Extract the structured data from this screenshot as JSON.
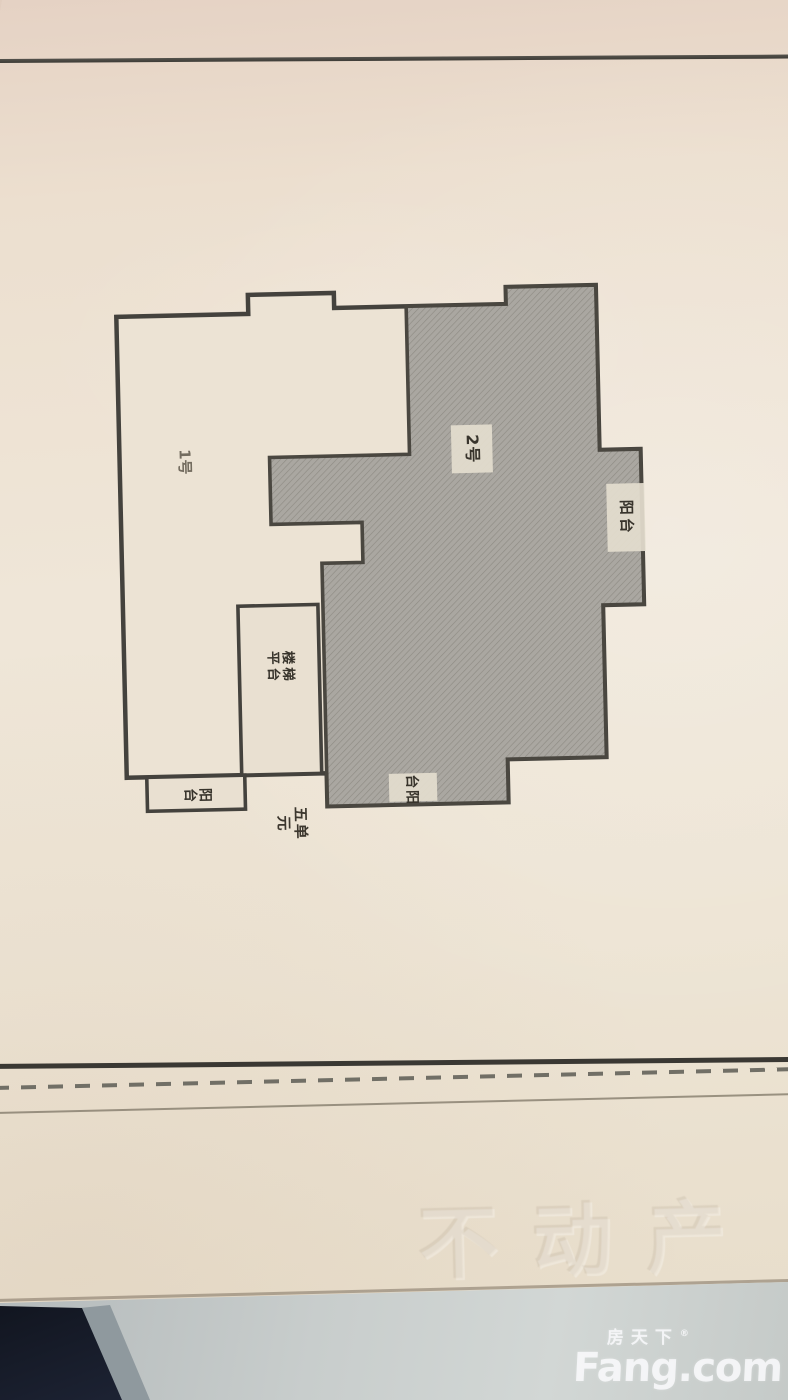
{
  "photo": {
    "paper": {
      "floor_plan": {
        "unit_1_label": "1号",
        "unit_2_label": "2号",
        "balcony_right_label": "阳台",
        "balcony_bottom_label": "阳台",
        "balcony_left_label": "阳台",
        "stair_label_line1": "楼梯",
        "stair_label_line2": "平台",
        "unit_entrance_label": "五单元"
      },
      "emboss_text": "不动产"
    },
    "watermark": {
      "brand_cn": "房天下",
      "brand_en": "Fang.com",
      "registered_mark": "®"
    },
    "colors": {
      "paper": "#ece3d4",
      "plan_outline": "#44423d",
      "hatch_fill": "#a9a6a0",
      "label_tag": "#e4ddce",
      "table_gray": "#c8cdcc",
      "dark_corner": "#161b2a",
      "watermark_white": "rgba(250,250,252,0.82)"
    }
  }
}
